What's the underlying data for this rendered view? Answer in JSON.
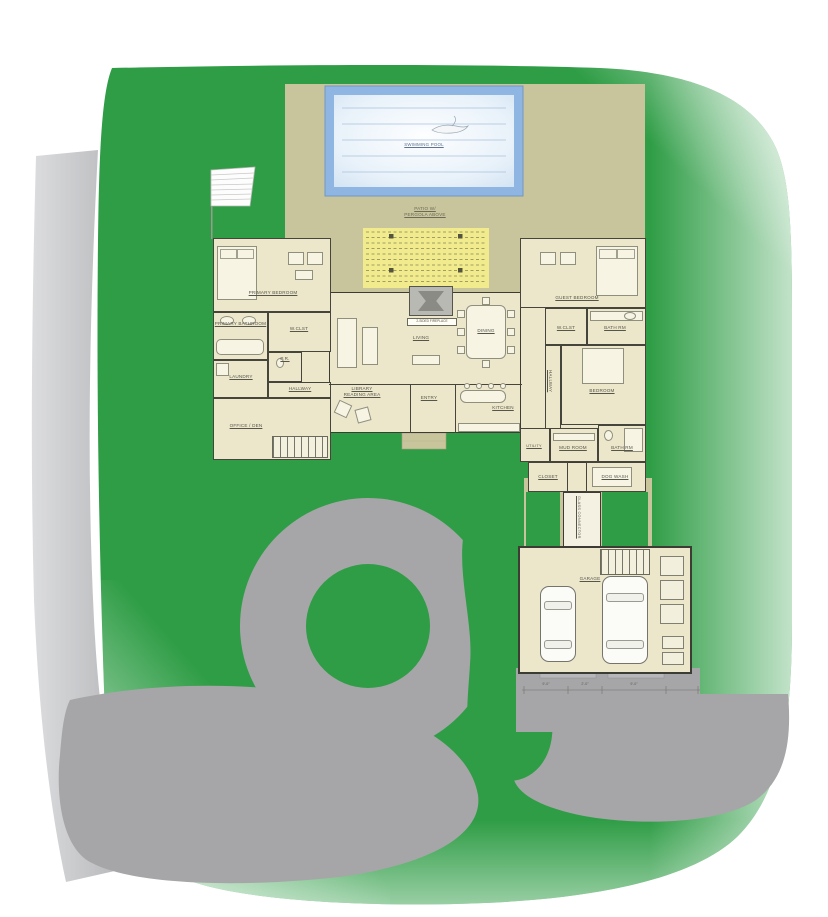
{
  "site": {
    "pool_label": "SWIMMING POOL",
    "patio_label": "PATIO W/ PERGOLA ABOVE",
    "connector_label": "GLASS CONNECTOR"
  },
  "rooms": {
    "primary_bedroom": "PRIMARY BEDROOM",
    "primary_bathroom": "PRIMARY BATHROOM",
    "wclst_left": "W.CLST",
    "laundry": "LAUNDRY",
    "pr": "P.R.",
    "hallway_left": "HALLWAY",
    "office_den": "OFFICE / DEN",
    "library": "LIBRARY READING AREA",
    "living": "LIVING",
    "dining": "DINING",
    "entry": "ENTRY",
    "kitchen": "KITCHEN",
    "guest_bedroom": "GUEST BEDROOM",
    "wclst_right": "W.CLST",
    "bath_upper": "BATH RM",
    "bedroom": "BEDROOM",
    "hallway_right": "HALLWAY",
    "utility": "UTILITY",
    "mud_room": "MUD ROOM",
    "bath_lower": "BATH RM",
    "closet": "CLOSET",
    "dog_wash": "DOG WASH",
    "garage": "GARAGE"
  },
  "annotations": {
    "fireplace_note": "2-SIDED FIREPLACE"
  },
  "dimensions": {
    "garage": [
      "9'-0\"",
      "2'-0\"",
      "9'-0\""
    ]
  },
  "colors": {
    "lawn": "#2f9d46",
    "driveway": "#a6a6a8",
    "road_light": "#c6c7c9",
    "patio_tan": "#c8c49b",
    "pergola_yellow": "#f2eb8e",
    "pool_edge": "#8fb5e2",
    "pool_water": "#eaf3fb",
    "floor": "#ece7cb",
    "wall": "#45453c"
  }
}
